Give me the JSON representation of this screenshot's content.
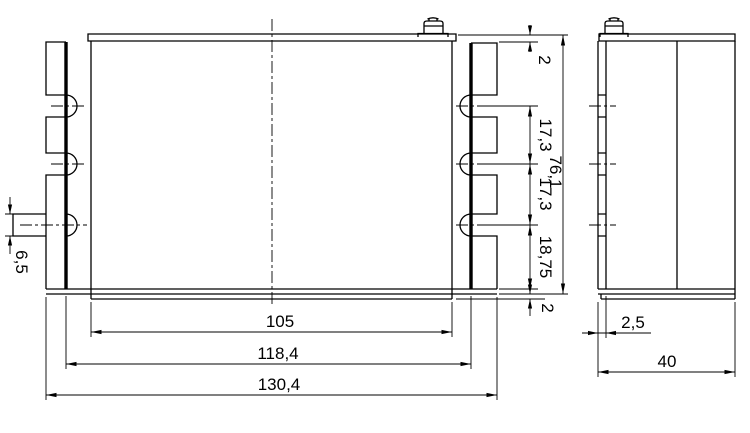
{
  "drawing": {
    "kind": "technical-dimension-drawing",
    "background": "#ffffff",
    "line_color": "#000000",
    "views": {
      "front": {
        "name": "front-view"
      },
      "side": {
        "name": "side-view"
      }
    },
    "dimensions": {
      "front_vertical_chain": [
        "2",
        "17,3",
        "17,3",
        "18,75",
        "2"
      ],
      "front_overall_height": "76,1",
      "front_widths": [
        "105",
        "118,4",
        "130,4"
      ],
      "front_tab_height": "6,5",
      "side_plate_thickness": "2,5",
      "side_depth": "40"
    }
  }
}
